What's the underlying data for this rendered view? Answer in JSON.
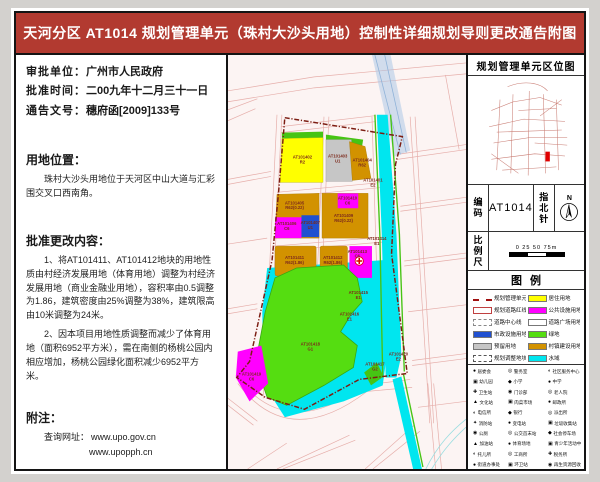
{
  "title": "天河分区 AT1014 规划管理单元（珠村大沙头用地）控制性详细规划导则更改通告附图",
  "left": {
    "approval": [
      {
        "label": "审批单位：",
        "value": "广州市人民政府"
      },
      {
        "label": "批准时间：",
        "value": "二00九年十二月三十一日"
      },
      {
        "label": "通告文号：",
        "value": "穗府函[2009]133号"
      }
    ],
    "location_heading": "用地位置：",
    "location_body": "珠村大沙头用地位于天河区中山大道与汇彩围交叉口西南角。",
    "changes_heading": "批准更改内容：",
    "changes": [
      "1、将AT101411、AT101412地块的用地性质由村经济发展用地（体育用地）调整为村经济发展用地（商业金融业用地），容积率由0.5调整为1.86，建筑密度由25%调整为38%，建筑限高由10米调整为24米。",
      "2、因本项目用地性质调整而减少了体育用地（面积6952平方米），需在南侧的杨桃公园内相应增加，杨桃公园绿化面积减少6952平方米。"
    ],
    "notes_heading": "附注：",
    "notes_label": "查询网址：",
    "urls": [
      "www.upo.gov.cn",
      "www.upopph.cn"
    ]
  },
  "map": {
    "parcels": [
      {
        "id": "AT101402",
        "code": "R2"
      },
      {
        "id": "AT101403",
        "code": "U1"
      },
      {
        "id": "AT101404",
        "code": "R62"
      },
      {
        "id": "AT101405",
        "code": "R62(0.22)"
      },
      {
        "id": "AT101406",
        "code": "C6"
      },
      {
        "id": "AT101407",
        "code": "U1"
      },
      {
        "id": "AT101409",
        "code": "R62(0.22)"
      },
      {
        "id": "AT101410",
        "code": "C6"
      },
      {
        "id": "AT101411",
        "code": "R62(1.86)"
      },
      {
        "id": "AT101412",
        "code": "R62(1.86)"
      },
      {
        "id": "AT101413",
        "code": "C6"
      },
      {
        "id": "AT101414",
        "code": "E1"
      },
      {
        "id": "AT101401",
        "code": "E2"
      },
      {
        "id": "AT101415",
        "code": "E1"
      },
      {
        "id": "AT101416",
        "code": "E1"
      },
      {
        "id": "AT101418",
        "code": "G1"
      },
      {
        "id": "AT101419",
        "code": "C6"
      },
      {
        "id": "AT101417",
        "code": "G2"
      },
      {
        "id": "AT101420",
        "code": "E2"
      }
    ]
  },
  "right": {
    "locator_title": "规划管理单元区位图",
    "code_label": "编码",
    "code_value": "AT1014",
    "north_label": "指北针",
    "north_n": "N",
    "scale_label": "比例尺",
    "scale_ticks": "0  25  50  75m",
    "legend_title": "图例",
    "legend_lines": [
      "规划管理单元界线",
      "规划道路红线",
      "道路中心线",
      "市政设施用地",
      "预留用地",
      "规划调整地块范围线"
    ],
    "legend_colors": [
      {
        "c": "#ffff00",
        "t": "居住用地"
      },
      {
        "c": "#ff00ff",
        "t": "公共设施用地"
      },
      {
        "c": "#ffffff",
        "t": "道路广场用地"
      },
      {
        "c": "#55dd11",
        "t": "绿地"
      },
      {
        "c": "#d29200",
        "t": "村镇建设用地"
      },
      {
        "c": "#00e6ef",
        "t": "水域"
      }
    ],
    "facilities": [
      {
        "g": "●",
        "t": "居委会"
      },
      {
        "g": "◎",
        "t": "警务室"
      },
      {
        "g": "◐",
        "t": "社区服务中心"
      },
      {
        "g": "▣",
        "t": "幼儿园"
      },
      {
        "g": "◆",
        "t": "小学"
      },
      {
        "g": "●",
        "t": "中学"
      },
      {
        "g": "✚",
        "t": "卫生站"
      },
      {
        "g": "◉",
        "t": "门诊部"
      },
      {
        "g": "◎",
        "t": "老人院"
      },
      {
        "g": "▲",
        "t": "文化站"
      },
      {
        "g": "▣",
        "t": "肉菜市场"
      },
      {
        "g": "●",
        "t": "邮政所"
      },
      {
        "g": "◐",
        "t": "电信所"
      },
      {
        "g": "◆",
        "t": "银行"
      },
      {
        "g": "◎",
        "t": "派出所"
      },
      {
        "g": "✦",
        "t": "消防站"
      },
      {
        "g": "●",
        "t": "变电站"
      },
      {
        "g": "▣",
        "t": "垃圾收集站"
      },
      {
        "g": "◉",
        "t": "公厕"
      },
      {
        "g": "◎",
        "t": "公交首末站"
      },
      {
        "g": "◆",
        "t": "社会停车场"
      },
      {
        "g": "▲",
        "t": "加油站"
      },
      {
        "g": "●",
        "t": "体育场地"
      },
      {
        "g": "▣",
        "t": "青少年活动中心"
      },
      {
        "g": "◐",
        "t": "托儿所"
      },
      {
        "g": "◎",
        "t": "工商所"
      },
      {
        "g": "✚",
        "t": "税务所"
      },
      {
        "g": "●",
        "t": "街道办事处"
      },
      {
        "g": "▣",
        "t": "环卫站"
      },
      {
        "g": "◉",
        "t": "再生资源回收点"
      }
    ]
  },
  "colors": {
    "title_bg": "#b23a30",
    "boundary": "#7c1d12",
    "road": "#e6aeaa",
    "water": "#00e6ef",
    "park": "#55dd11",
    "village": "#d29200"
  }
}
